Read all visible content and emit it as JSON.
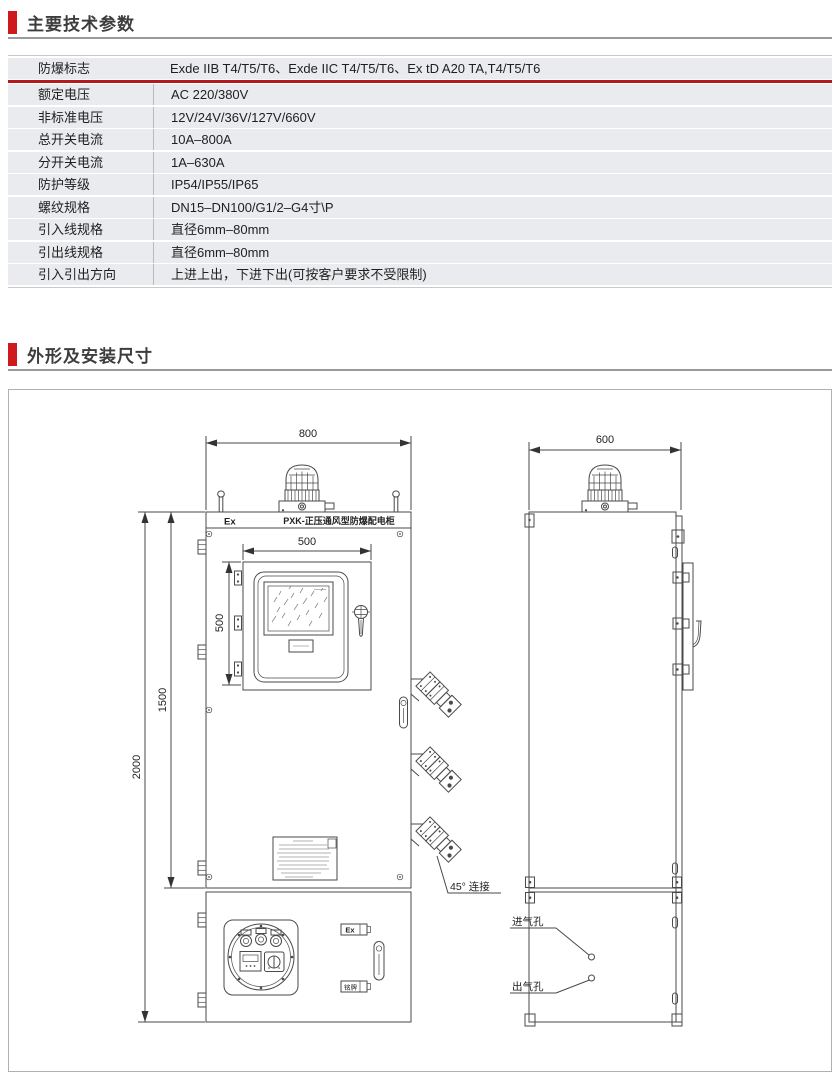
{
  "colors": {
    "accent_red": "#ce1a1d",
    "rule_red": "#b21a20",
    "row_bg": "#e9ebee"
  },
  "sections": {
    "specs_title": "主要技术参数",
    "dims_title": "外形及安装尺寸"
  },
  "spec_table": {
    "rows": [
      {
        "label": "防爆标志",
        "value": "Exde IIB T4/T5/T6、Exde IIC T4/T5/T6、Ex tD  A20 TA,T4/T5/T6"
      },
      {
        "label": "额定电压",
        "value": "AC 220/380V"
      },
      {
        "label": "非标准电压",
        "value": "12V/24V/36V/127V/660V"
      },
      {
        "label": "总开关电流",
        "value": "10A–800A"
      },
      {
        "label": "分开关电流",
        "value": "1A–630A"
      },
      {
        "label": "防护等级",
        "value": "IP54/IP55/IP65"
      },
      {
        "label": "螺纹规格",
        "value": "DN15–DN100/G1/2–G4寸\\P"
      },
      {
        "label": "引入线规格",
        "value": "直径6mm–80mm"
      },
      {
        "label": "引出线规格",
        "value": "直径6mm–80mm"
      },
      {
        "label": "引入引出方向",
        "value": "上进上出，下进下出(可按客户要求不受限制)"
      }
    ]
  },
  "drawing": {
    "front": {
      "dim_width": "800",
      "dim_door_w": "500",
      "dim_door_h": "500",
      "dim_body_h": "1500",
      "dim_total_h": "2000",
      "ex_mark": "Ex",
      "band_title": "PXK-正压通风型防爆配电柜",
      "note_45": "45°  连接",
      "plate_ex": "Ex",
      "plate_name": "铭牌"
    },
    "side": {
      "dim_depth": "600",
      "label_inlet": "进气孔",
      "label_outlet": "出气孔"
    }
  }
}
